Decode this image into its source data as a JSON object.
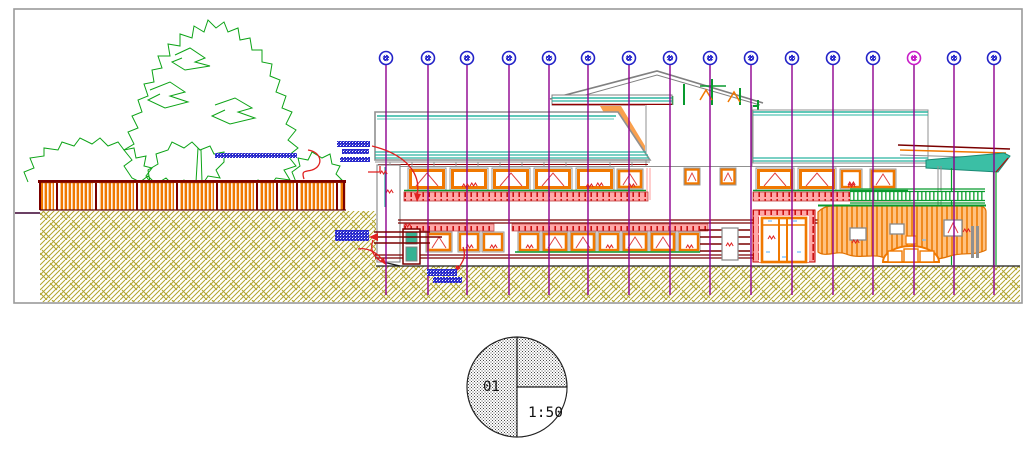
{
  "drawing": {
    "scale_symbol": {
      "sheet_number": "01",
      "scale_ratio": "1:50"
    },
    "grid": {
      "axis_line_color": "#8E008E",
      "bubble_stroke": "#2323C8",
      "highlight_stroke": "#C81EC8",
      "highlighted_index": 13,
      "bubble_cy": 58,
      "bubble_r": 6.5,
      "line_top": 64.5,
      "line_bottom": 295,
      "positions": [
        386,
        428,
        467,
        509,
        549,
        588,
        629,
        670,
        710,
        751,
        792,
        833,
        873,
        914,
        954,
        994
      ]
    },
    "palette": {
      "tree_green": "#0CA316",
      "fence_orange": "#F07800",
      "fence_post_dark_red": "#7A0000",
      "earth_hatch_olive": "#B2A52E",
      "roof_teal": "#2AB5A0",
      "outline_gray": "#909090",
      "frame_orange": "#F07800",
      "slab_salmon": "#FFA8A8",
      "slab_dash_red": "#CC1111",
      "floor_dark_red": "#7A0000",
      "leader_red": "#E02020",
      "mullion_green": "#089A2E",
      "door_teal": "#35B393",
      "annotation_blue": "#2A2ACC",
      "border_gray": "#9A9A9A"
    }
  }
}
